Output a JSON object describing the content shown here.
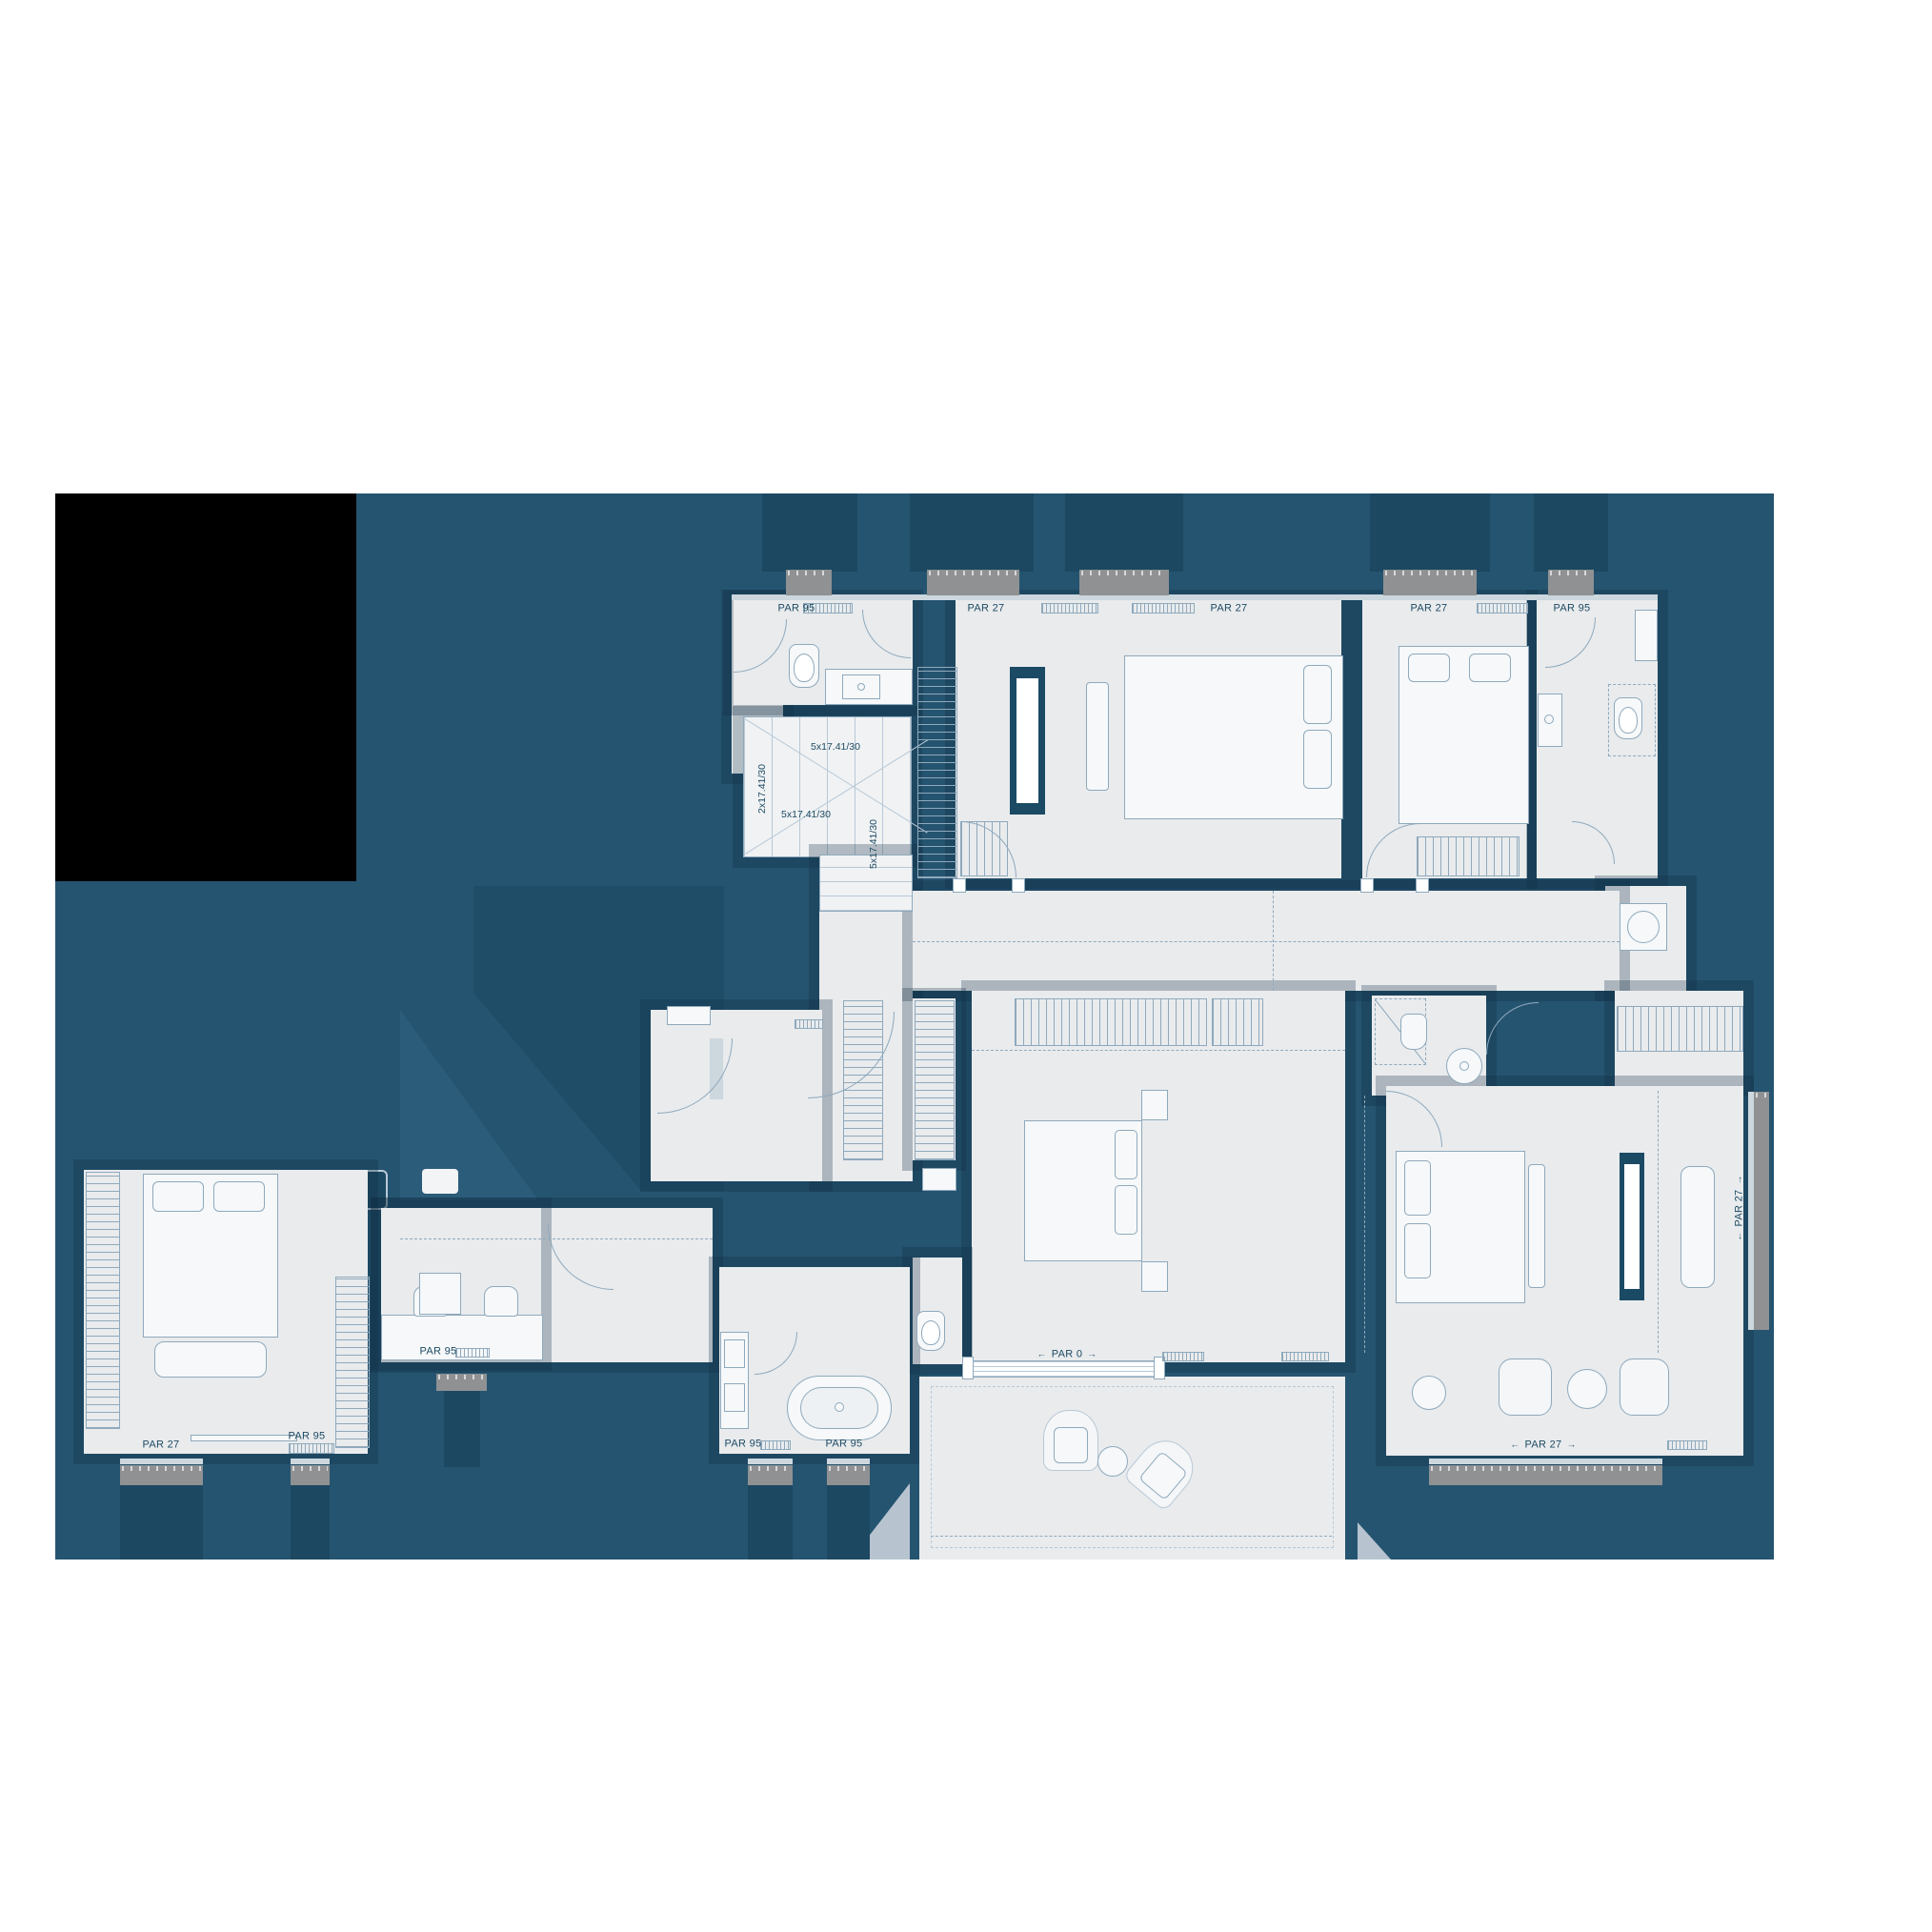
{
  "plan": {
    "arrow_left": "←",
    "arrow_right": "→",
    "labels": [
      {
        "id": "bath-top-left",
        "text": "PAR 95"
      },
      {
        "id": "bedroom-top-1-left",
        "text": "PAR 27"
      },
      {
        "id": "bedroom-top-1-right",
        "text": "PAR 27"
      },
      {
        "id": "bedroom-top-2",
        "text": "PAR 27"
      },
      {
        "id": "bath-top-right",
        "text": "PAR 95"
      },
      {
        "id": "master-terrace-door",
        "text": "PAR 0"
      },
      {
        "id": "suite-right-wall",
        "text": "PAR 27"
      },
      {
        "id": "bedroom-bottom-left",
        "text": "PAR 27"
      },
      {
        "id": "bedroom-bottom-left-2",
        "text": "PAR 95"
      },
      {
        "id": "dressing-room",
        "text": "PAR 95"
      },
      {
        "id": "master-bath-left",
        "text": "PAR 95"
      },
      {
        "id": "master-bath-center",
        "text": "PAR 95"
      },
      {
        "id": "suite-bottom",
        "text": "PAR 27"
      }
    ],
    "stair_annotations": [
      {
        "id": "flight-top",
        "text": "5x17.41/30"
      },
      {
        "id": "flight-left",
        "text": "2x17.41/30"
      },
      {
        "id": "flight-mid",
        "text": "5x17.41/30"
      },
      {
        "id": "flight-down",
        "text": "5x17.41/30"
      }
    ],
    "colors": {
      "roof_background": "#255470",
      "wall": "#1b4a64",
      "room_fill": "#e9ebed",
      "window_gray": "#8f9193",
      "label_text": "#1d4a63",
      "masked_area": "#000000"
    }
  }
}
